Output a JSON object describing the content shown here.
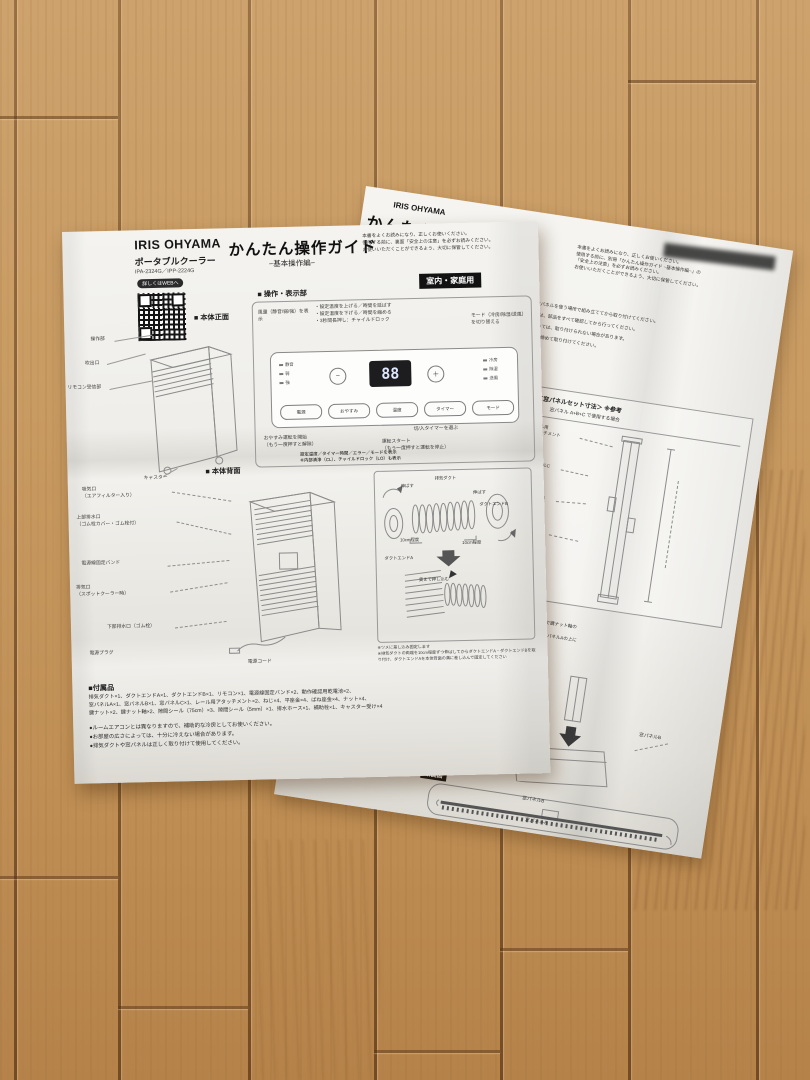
{
  "front_sheet": {
    "brand": "IRIS OHYAMA",
    "product": "ポータブルクーラー",
    "models": "IPA-2324G／IPP-2224G",
    "qr_label": "詳しくはWEBへ",
    "title": "かんたん操作ガイド",
    "subtitle": "−基本操作編−",
    "intro": "本書をよくお読みになり、正しくお使いください。\n使用する前に、裏面「安全上の注意」を必ずお読みください。\nお使いいただくことができるよう、大切に保管してください。",
    "usage_badge": "室内・家庭用",
    "panel": {
      "heading": "■ 操作・表示部",
      "ann_fan": "風量（静音/弱/強）を表示",
      "ann_updown": "・設定温度を上げる／時間を延ばす\n・設定温度を下げる／時間を縮める\n・3秒間長押し：チャイルドロック",
      "ann_mode": "モード（冷房/除湿/送風）を切り替える",
      "led_left": [
        "静音",
        "弱",
        "強"
      ],
      "led_right": [
        "冷房",
        "除湿",
        "送風"
      ],
      "display": "88",
      "buttons": [
        "電源",
        "おやすみ",
        "温度",
        "タイマー",
        "モード"
      ],
      "ann_timer": "切/入タイマーを選ぶ",
      "ann_sleep": "おやすみ運転を開始\n（もう一度押すと解除）",
      "ann_start": "運転スタート\n（もう一度押すと運転を停止）",
      "ann_display": "設定温度／タイマー時間／エラー／モードを表示\n※内部清浄（CL）、チャイルドロック（LO）も表示"
    },
    "front_view": {
      "heading": "■ 本体正面",
      "labels": [
        "操作部",
        "吹出口",
        "リモコン受信部",
        "キャスター"
      ]
    },
    "back_view": {
      "heading": "■ 本体背面",
      "labels": [
        "吸気口\n（エアフィルター入り）",
        "上部排水口\n（ゴム栓カバー・ゴム栓付）",
        "電源線固定バンド",
        "排気口\n（スポットクーラー時）",
        "下部排水口（ゴム栓）",
        "電源プラグ",
        "電源コード"
      ],
      "duct": {
        "labels": [
          "伸ばす",
          "排気ダクト",
          "伸ばす",
          "ダクトエンドB",
          "10cm程度",
          "10cm程度",
          "ダクトエンドA",
          "奥まで押し込む"
        ],
        "notes": "※ツメに差し込み固定します\n※排気ダクトの両端を10cm程度ずつ伸ばしてからダクトエンドA・ダクトエンドBを取り付け、ダクトエンドAを本体背面の溝に差し込んで固定してください"
      }
    },
    "accessories": {
      "heading": "■付属品",
      "lines": "排気ダクト×1、ダクトエンドA×1、ダクトエンドB×1、リモコン×1、電源線固定バンド×2、動作確認用乾電池×2、\n窓パネルA×1、窓パネルB×1、窓パネルC×1、レール用アタッチメント×2、ねじ×4、平座金×4、ばね座金×4、ナット×4、\n鍵ナット×2、鍵ナット軸×2、隙間シール（75cm）×3、隙間シール（5mm）×1、排水ホース×1、補助栓×1、キャスター受け×4"
    },
    "notes": [
      "●ルームエアコンとは異なりますので、補助的な冷房としてお使いください。",
      "●お部屋の広さによっては、十分に冷えない場合があります。",
      "●排気ダクトや窓パネルは正しく取り付けて使用してください。"
    ]
  },
  "back_sheet": {
    "brand": "IRIS OHYAMA",
    "title": "かんたん操作ガイド",
    "subtitle": "−組み立て・取り付け編−",
    "intro": "本書をよくお読みになり、正しくお使いください。\n使用する前に、別冊「かんたん操作ガイド −基本操作編−」の\n「安全上の注意」を必ずお読みください。\nお使いいただくことができるよう、大切に保管してください。",
    "bullets": [
      "●設置するときは、窓パネルを使う場所で組み立ててから取り付けてください。",
      "●組み立てや取り付けは、部品をすべて確認してから行ってください。",
      "●窓の形状や寸法によっては、取り付けられない場合があります。",
      "●固定ネジはしっかりと締めて取り付けてください。"
    ],
    "fragments": [
      "ことができます",
      "ルを取り付け."
    ],
    "step_number": "1",
    "dim": {
      "heading": "＜窓パネルセット寸法＞ ※参考",
      "sub": "窓パネル A+B+C で使用する場合",
      "labels": [
        "レール用\nアタッチメント",
        "窓パネルC",
        "窓パネルB",
        "窓パネルA",
        "レール用\nアタッチメント"
      ]
    },
    "attach": {
      "heading": "窓パネルBを窓パネルAに取り付ける",
      "body": "・窓パネルBを窓に合わせるために、鍵ナットで鍵ナット軸の\n　穴位置を調整してください。\n・窓が高い場合は、窓パネルB、窓パネルCを窓パネルAの上に\n　重ねて差し込んでください。",
      "common": "窓パネル（A,B）・（A,B,C）使用 共通",
      "labels": [
        "鍵ナット軸",
        "窓パネルA",
        "窓パネルB"
      ]
    },
    "cross": {
      "label": "断面図",
      "labels": [
        "窓パネルB",
        "窓パネルA"
      ]
    }
  }
}
